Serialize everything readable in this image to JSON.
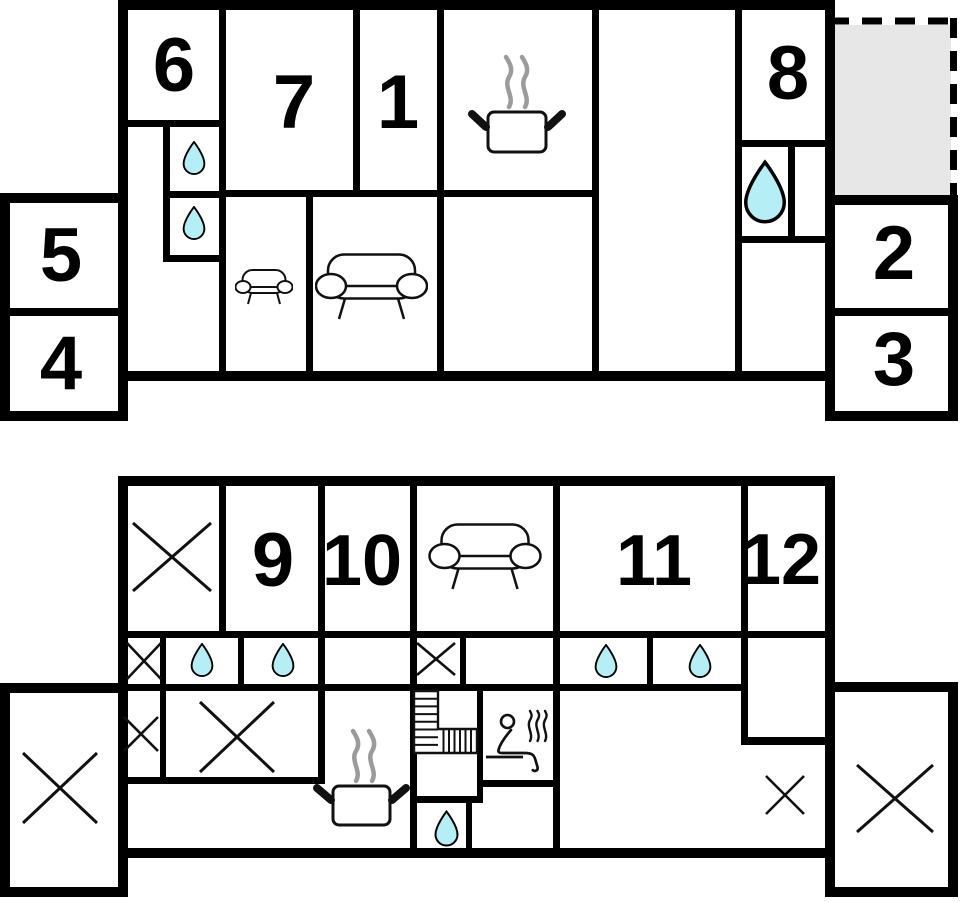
{
  "page": {
    "type": "floor-plan",
    "floor_count": 2
  },
  "colors": {
    "wall": "#000000",
    "outline": "#111111",
    "water_fill": "#b5eef4",
    "terrace_fill": "#e7e7e7",
    "steam_gray": "#9b9b9b",
    "background": "#ffffff"
  },
  "upper_floor": {
    "name": "upper-floor-plan",
    "labels": {
      "room1": "1",
      "room2": "2",
      "room3": "3",
      "room4": "4",
      "room5": "5",
      "room6": "6",
      "room7": "7",
      "room8": "8"
    },
    "icons": [
      "water-drop-icon",
      "water-drop-icon",
      "water-drop-large-icon",
      "cooking-pot-icon",
      "sofa-small-icon",
      "sofa-large-icon"
    ],
    "features": [
      "terrace-dashed-area"
    ]
  },
  "lower_floor": {
    "name": "lower-floor-plan",
    "labels": {
      "room9": "9",
      "room10": "10",
      "room11": "11",
      "room12": "12"
    },
    "icons": [
      "crossed-room-icon",
      "crossed-room-icon",
      "crossed-room-icon",
      "crossed-room-icon",
      "crossed-cell-icon",
      "crossed-cell-icon",
      "crossed-cell-icon",
      "crossed-cell-icon",
      "water-drop-icon",
      "water-drop-icon",
      "water-drop-icon",
      "water-drop-icon",
      "water-drop-icon",
      "sofa-large-icon",
      "stairs-icon",
      "sauna-icon",
      "cooking-pot-icon"
    ]
  }
}
